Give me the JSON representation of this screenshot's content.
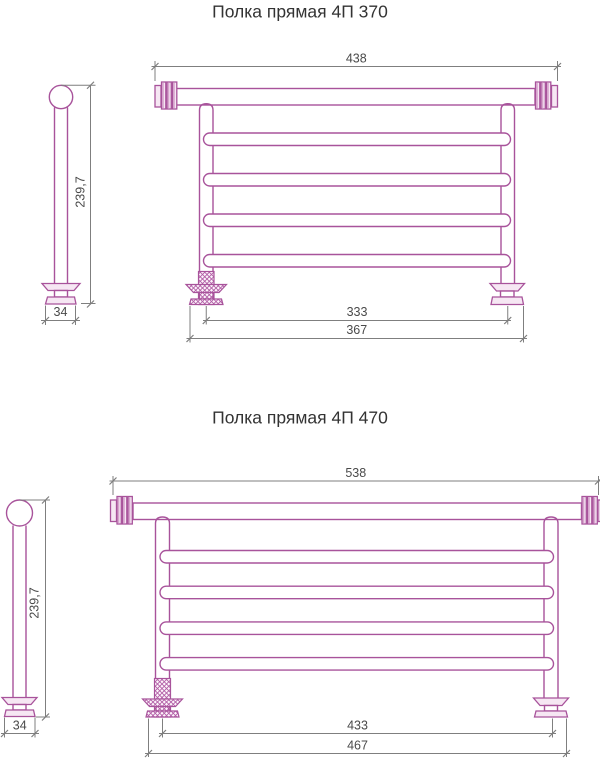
{
  "colors": {
    "object_line": "#a8539b",
    "object_tint": "#f6e7f3",
    "rib_shade": "#c783ba",
    "hatch_line": "#b25fa7",
    "hatch_bg": "#fdf4fb",
    "dim_line": "#7f7f7f",
    "dim_text": "#4a4a4a",
    "title_text": "#333333",
    "background": "#ffffff"
  },
  "drawings": [
    {
      "title": "Полка прямая 4П 370",
      "front_view": {
        "overall_width": "438",
        "rail_span": "333",
        "mount_span": "367",
        "rail_count": 4
      },
      "side_view": {
        "height": "239,7",
        "depth": "34"
      }
    },
    {
      "title": "Полка прямая 4П 470",
      "front_view": {
        "overall_width": "538",
        "rail_span": "433",
        "mount_span": "467",
        "rail_count": 4
      },
      "side_view": {
        "height": "239,7",
        "depth": "34"
      }
    }
  ]
}
